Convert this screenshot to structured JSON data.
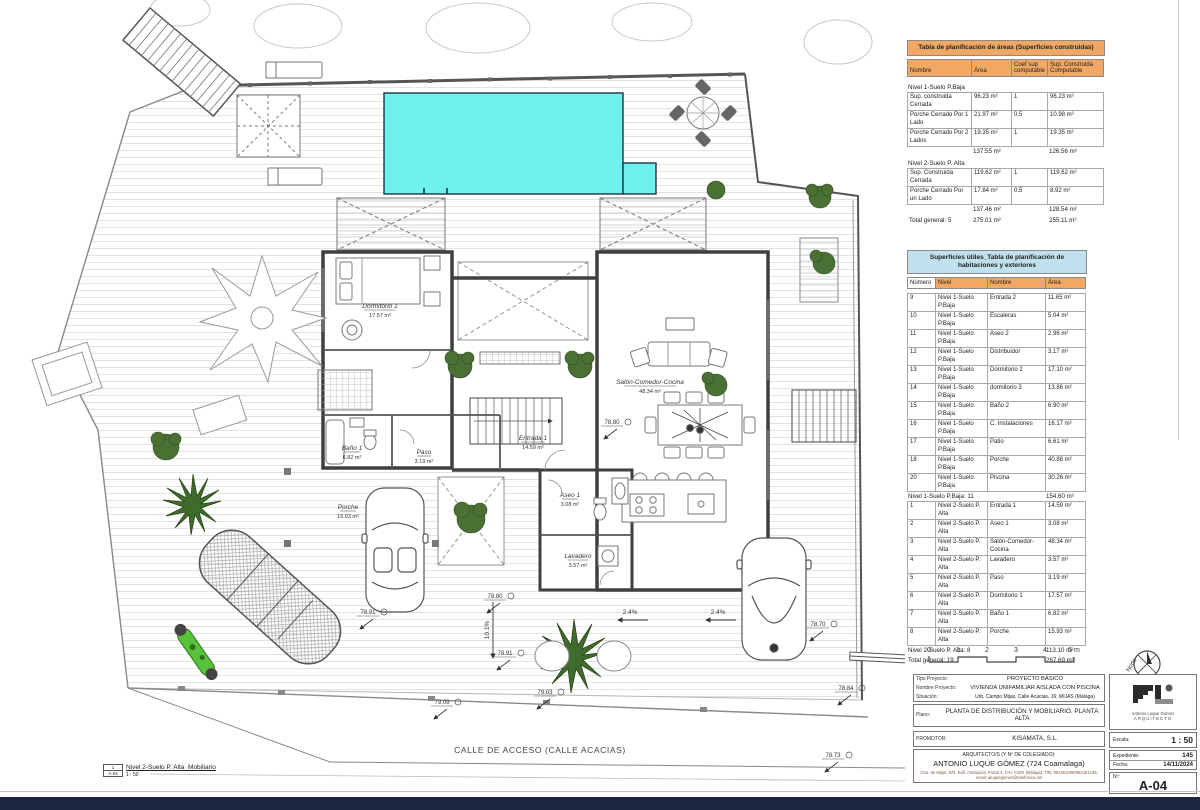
{
  "colors": {
    "accent_orange": "#f2a862",
    "accent_blue": "#bfe0ec",
    "pool": "#6ff0ee",
    "bottom_bar": "#1b2542"
  },
  "areas_table": {
    "title": "Tabla de planificación de áreas (Superficies construidas)",
    "headers": [
      "Nombre",
      "Área",
      "Coef sup computable",
      "Sup. Construida Computable"
    ],
    "groups": [
      {
        "name": "Nivel 1-Suelo P.Baja",
        "rows": [
          [
            "Sup. construida Cerrada",
            "96.23 m²",
            "1",
            "96.23 m²"
          ],
          [
            "Porche Cerrado Por 1 Lado",
            "21.97 m²",
            "0.5",
            "10.98 m²"
          ],
          [
            "Porche Cerrado Por 2 Lados",
            "19.35 m²",
            "1",
            "19.35 m²"
          ]
        ],
        "subtotal": [
          "",
          "137.55 m²",
          "",
          "126.56 m²"
        ]
      },
      {
        "name": "Nivel 2-Suelo P. Alta",
        "rows": [
          [
            "Sup. Construida Cerrada",
            "119.62 m²",
            "1",
            "119.62 m²"
          ],
          [
            "Porche Cerrado Por un Lado",
            "17.84 m²",
            "0.5",
            "8.92 m²"
          ]
        ],
        "subtotal": [
          "",
          "137.46 m²",
          "",
          "128.54 m²"
        ]
      }
    ],
    "total": [
      "Total general: 5",
      "275.01 m²",
      "",
      "255.11 m²"
    ]
  },
  "rooms_table": {
    "title": "Superficies útiles_Tabla de planificación de habitaciones y exteriores",
    "headers": [
      "Número",
      "Nivel",
      "Nombre",
      "Área"
    ],
    "groups": [
      {
        "rows": [
          [
            "9",
            "Nivel 1-Suelo P.Baja",
            "Entrada 2",
            "11.65 m²"
          ],
          [
            "10",
            "Nivel 1-Suelo P.Baja",
            "Escaleras",
            "5.04 m²"
          ],
          [
            "11",
            "Nivel 1-Suelo P.Baja",
            "Aseo 2",
            "2.96 m²"
          ],
          [
            "12",
            "Nivel 1-Suelo P.Baja",
            "Distribuidor",
            "3.17 m²"
          ],
          [
            "13",
            "Nivel 1-Suelo P.Baja",
            "Dormitorio 2",
            "17.10 m²"
          ],
          [
            "14",
            "Nivel 1-Suelo P.Baja",
            "dormitorio 3",
            "13.86 m²"
          ],
          [
            "15",
            "Nivel 1-Suelo P.Baja",
            "Baño 2",
            "6.90 m²"
          ],
          [
            "16",
            "Nivel 1-Suelo P.Baja",
            "C. Instalaciones",
            "16.17 m²"
          ],
          [
            "17",
            "Nivel 1-Suelo P.Baja",
            "Patio",
            "6.61 m²"
          ],
          [
            "18",
            "Nivel 1-Suelo P.Baja",
            "Porche",
            "40.88 m²"
          ],
          [
            "20",
            "Nivel 1-Suelo P.Baja",
            "Piscina",
            "30.26 m²"
          ]
        ],
        "subtotal": [
          "Nivel 1-Suelo P.Baja: 11",
          "154.60 m²"
        ]
      },
      {
        "rows": [
          [
            "1",
            "Nivel 2-Suelo P. Alta",
            "Entrada 1",
            "14.59 m²"
          ],
          [
            "2",
            "Nivel 2-Suelo P. Alta",
            "Aseo 1",
            "3.08 m²"
          ],
          [
            "3",
            "Nivel 2-Suelo P. Alta",
            "Salón-Comedor-Cocina",
            "48.34 m²"
          ],
          [
            "4",
            "Nivel 2-Suelo P. Alta",
            "Lavadero",
            "3.57 m²"
          ],
          [
            "5",
            "Nivel 2-Suelo P. Alta",
            "Paso",
            "3.19 m²"
          ],
          [
            "6",
            "Nivel 2-Suelo P. Alta",
            "Dormitorio 1",
            "17.57 m²"
          ],
          [
            "7",
            "Nivel 2-Suelo P. Alta",
            "Baño 1",
            "6.82 m²"
          ],
          [
            "8",
            "Nivel 2-Suelo P. Alta",
            "Porche",
            "15.93 m²"
          ]
        ],
        "subtotal": [
          "Nivel 2-Suelo P. Alta: 8",
          "113.10 m²"
        ]
      }
    ],
    "total": [
      "Total general: 19",
      "267.69 m²"
    ]
  },
  "scalebar": {
    "ticks": [
      "0",
      "1",
      "2",
      "3",
      "4",
      "5 m"
    ]
  },
  "north": {
    "label": "Norte"
  },
  "titleblock": {
    "tipo": {
      "label": "Tipo Proyecto:",
      "value": "PROYECTO BÁSICO"
    },
    "nombre": {
      "label": "Nombre Proyecto:",
      "value": "VIVIENDA UNIFAMILIAR AISLADA CON PISCINA"
    },
    "situacion": {
      "label": "Situación:",
      "value": "Urb. Campo Mijas, Calle Acacias, 16; MIJAS (Málaga)"
    },
    "plano": {
      "label": "Plano:",
      "value": "PLANTA DE DISTRIBUCIÓN Y MOBILIARIO. PLANTA ALTA"
    },
    "promotor": {
      "label": "PROMOTOR:",
      "value": "KISAMATA, S.L."
    },
    "arquitecto": {
      "label": "ARQUITECTO/S (Y Nº DE COLEGIADO):",
      "value": "ANTONIO LUQUE GÓMEZ (724 Coamalaga)",
      "note": "Ctra. de Mijas, S/N, Edif. Andalucía, Portal 4, 1ºH, COÍN (Málaga); Tlfs: 952451008/952451236; email: aluquegomez@telefonica.net"
    },
    "logo": {
      "name": "Antonio Luque Gómez",
      "title": "ARQUITECTO"
    },
    "escala": {
      "label": "Escala:",
      "value": "1 : 50"
    },
    "expediente": {
      "label": "Expediente:",
      "value": "145"
    },
    "fecha": {
      "label": "Fecha:",
      "value": "14/11/2024"
    },
    "numero": {
      "label": "Nº:",
      "value": "A-04"
    }
  },
  "legend": {
    "index": "1",
    "sheet": "A-04",
    "title": "Nivel 2-Suelo P. Alta_Mobiliario",
    "scale": "1 : 50"
  },
  "plan": {
    "street": "CALLE DE ACCESO (CALLE ACACIAS)",
    "street_x": 540,
    "street_y": 753,
    "rooms": [
      {
        "name": "Dormitorio 1",
        "area": "17.57 m²",
        "x": 380,
        "y": 308
      },
      {
        "name": "Baño 1",
        "area": "6.82 m²",
        "x": 352,
        "y": 450
      },
      {
        "name": "Paso",
        "area": "3.19 m²",
        "x": 424,
        "y": 454
      },
      {
        "name": "Entrada 1",
        "area": "14.59 m²",
        "x": 533,
        "y": 440
      },
      {
        "name": "Salón-Comedor-Cocina",
        "area": "48.34 m²",
        "x": 650,
        "y": 384
      },
      {
        "name": "Aseo 1",
        "area": "3.08 m²",
        "x": 570,
        "y": 497
      },
      {
        "name": "Lavadero",
        "area": "3.57 m²",
        "x": 578,
        "y": 558
      },
      {
        "name": "Porche",
        "area": "15.93 m²",
        "x": 348,
        "y": 509
      }
    ],
    "elevations": [
      {
        "v": "78.80",
        "x": 612,
        "y": 424
      },
      {
        "v": "78.80",
        "x": 495,
        "y": 598
      },
      {
        "v": "78.91",
        "x": 505,
        "y": 655
      },
      {
        "v": "78.91",
        "x": 368,
        "y": 614
      },
      {
        "v": "78.70",
        "x": 818,
        "y": 626
      },
      {
        "v": "78.84",
        "x": 846,
        "y": 690
      },
      {
        "v": "78.73",
        "x": 833,
        "y": 757
      },
      {
        "v": "79.03",
        "x": 545,
        "y": 694
      },
      {
        "v": "79.09",
        "x": 442,
        "y": 704
      }
    ],
    "slopes": [
      {
        "v": "2.4%",
        "x": 630,
        "y": 614,
        "rot": 0
      },
      {
        "v": "2.4%",
        "x": 718,
        "y": 614,
        "rot": 0
      },
      {
        "v": "10.1%",
        "x": 489,
        "y": 630,
        "rot": -90
      }
    ]
  }
}
